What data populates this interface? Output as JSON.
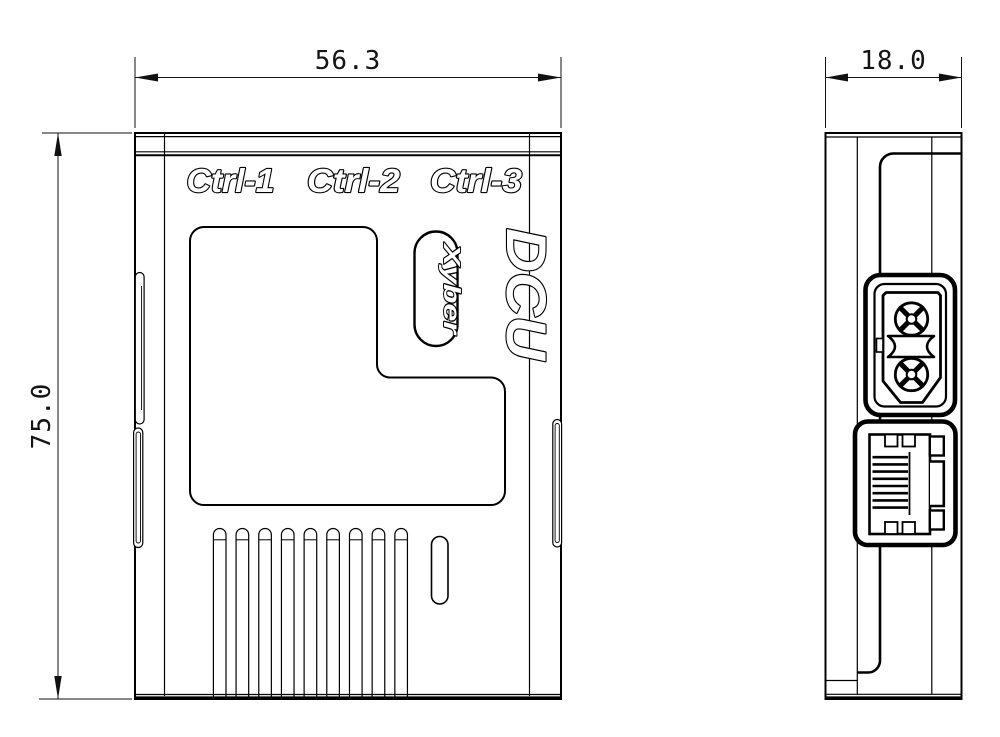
{
  "dimensions": {
    "width_mm": "56.3",
    "height_mm": "75.0",
    "depth_mm": "18.0"
  },
  "front": {
    "port_labels": [
      "Ctrl-1",
      "Ctrl-2",
      "Ctrl-3"
    ],
    "logo": "DCU",
    "brand": "Xyber",
    "vent_count": 9
  },
  "colors": {
    "line": "#000000",
    "background": "#ffffff"
  }
}
